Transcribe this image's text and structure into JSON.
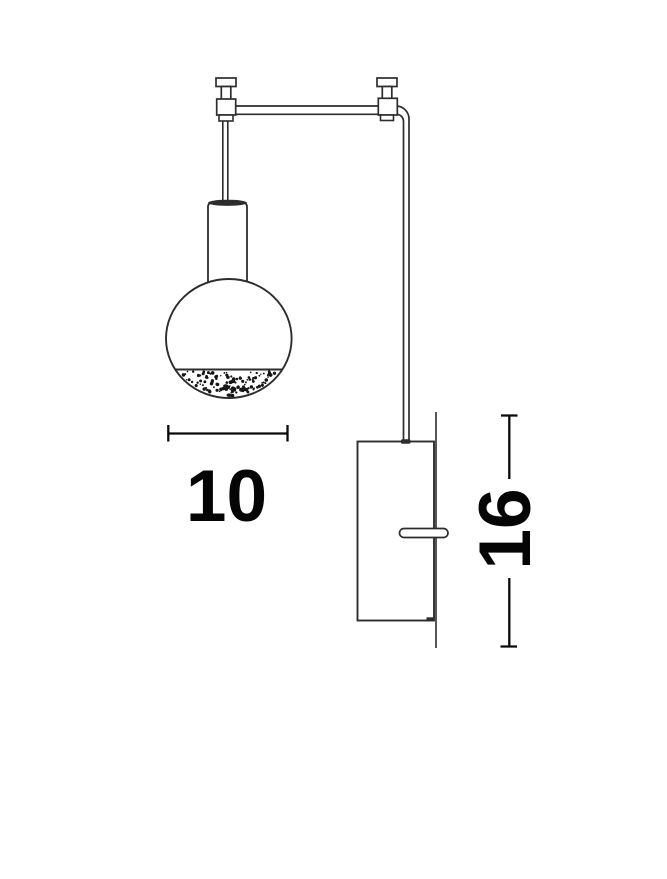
{
  "drawing": {
    "background": "#ffffff",
    "line_color": "#2d2d2d",
    "dimension_color": "#0a0a0a"
  },
  "dimensions": {
    "globe_width": {
      "label": "10"
    },
    "plate_height": {
      "label": "16"
    }
  }
}
